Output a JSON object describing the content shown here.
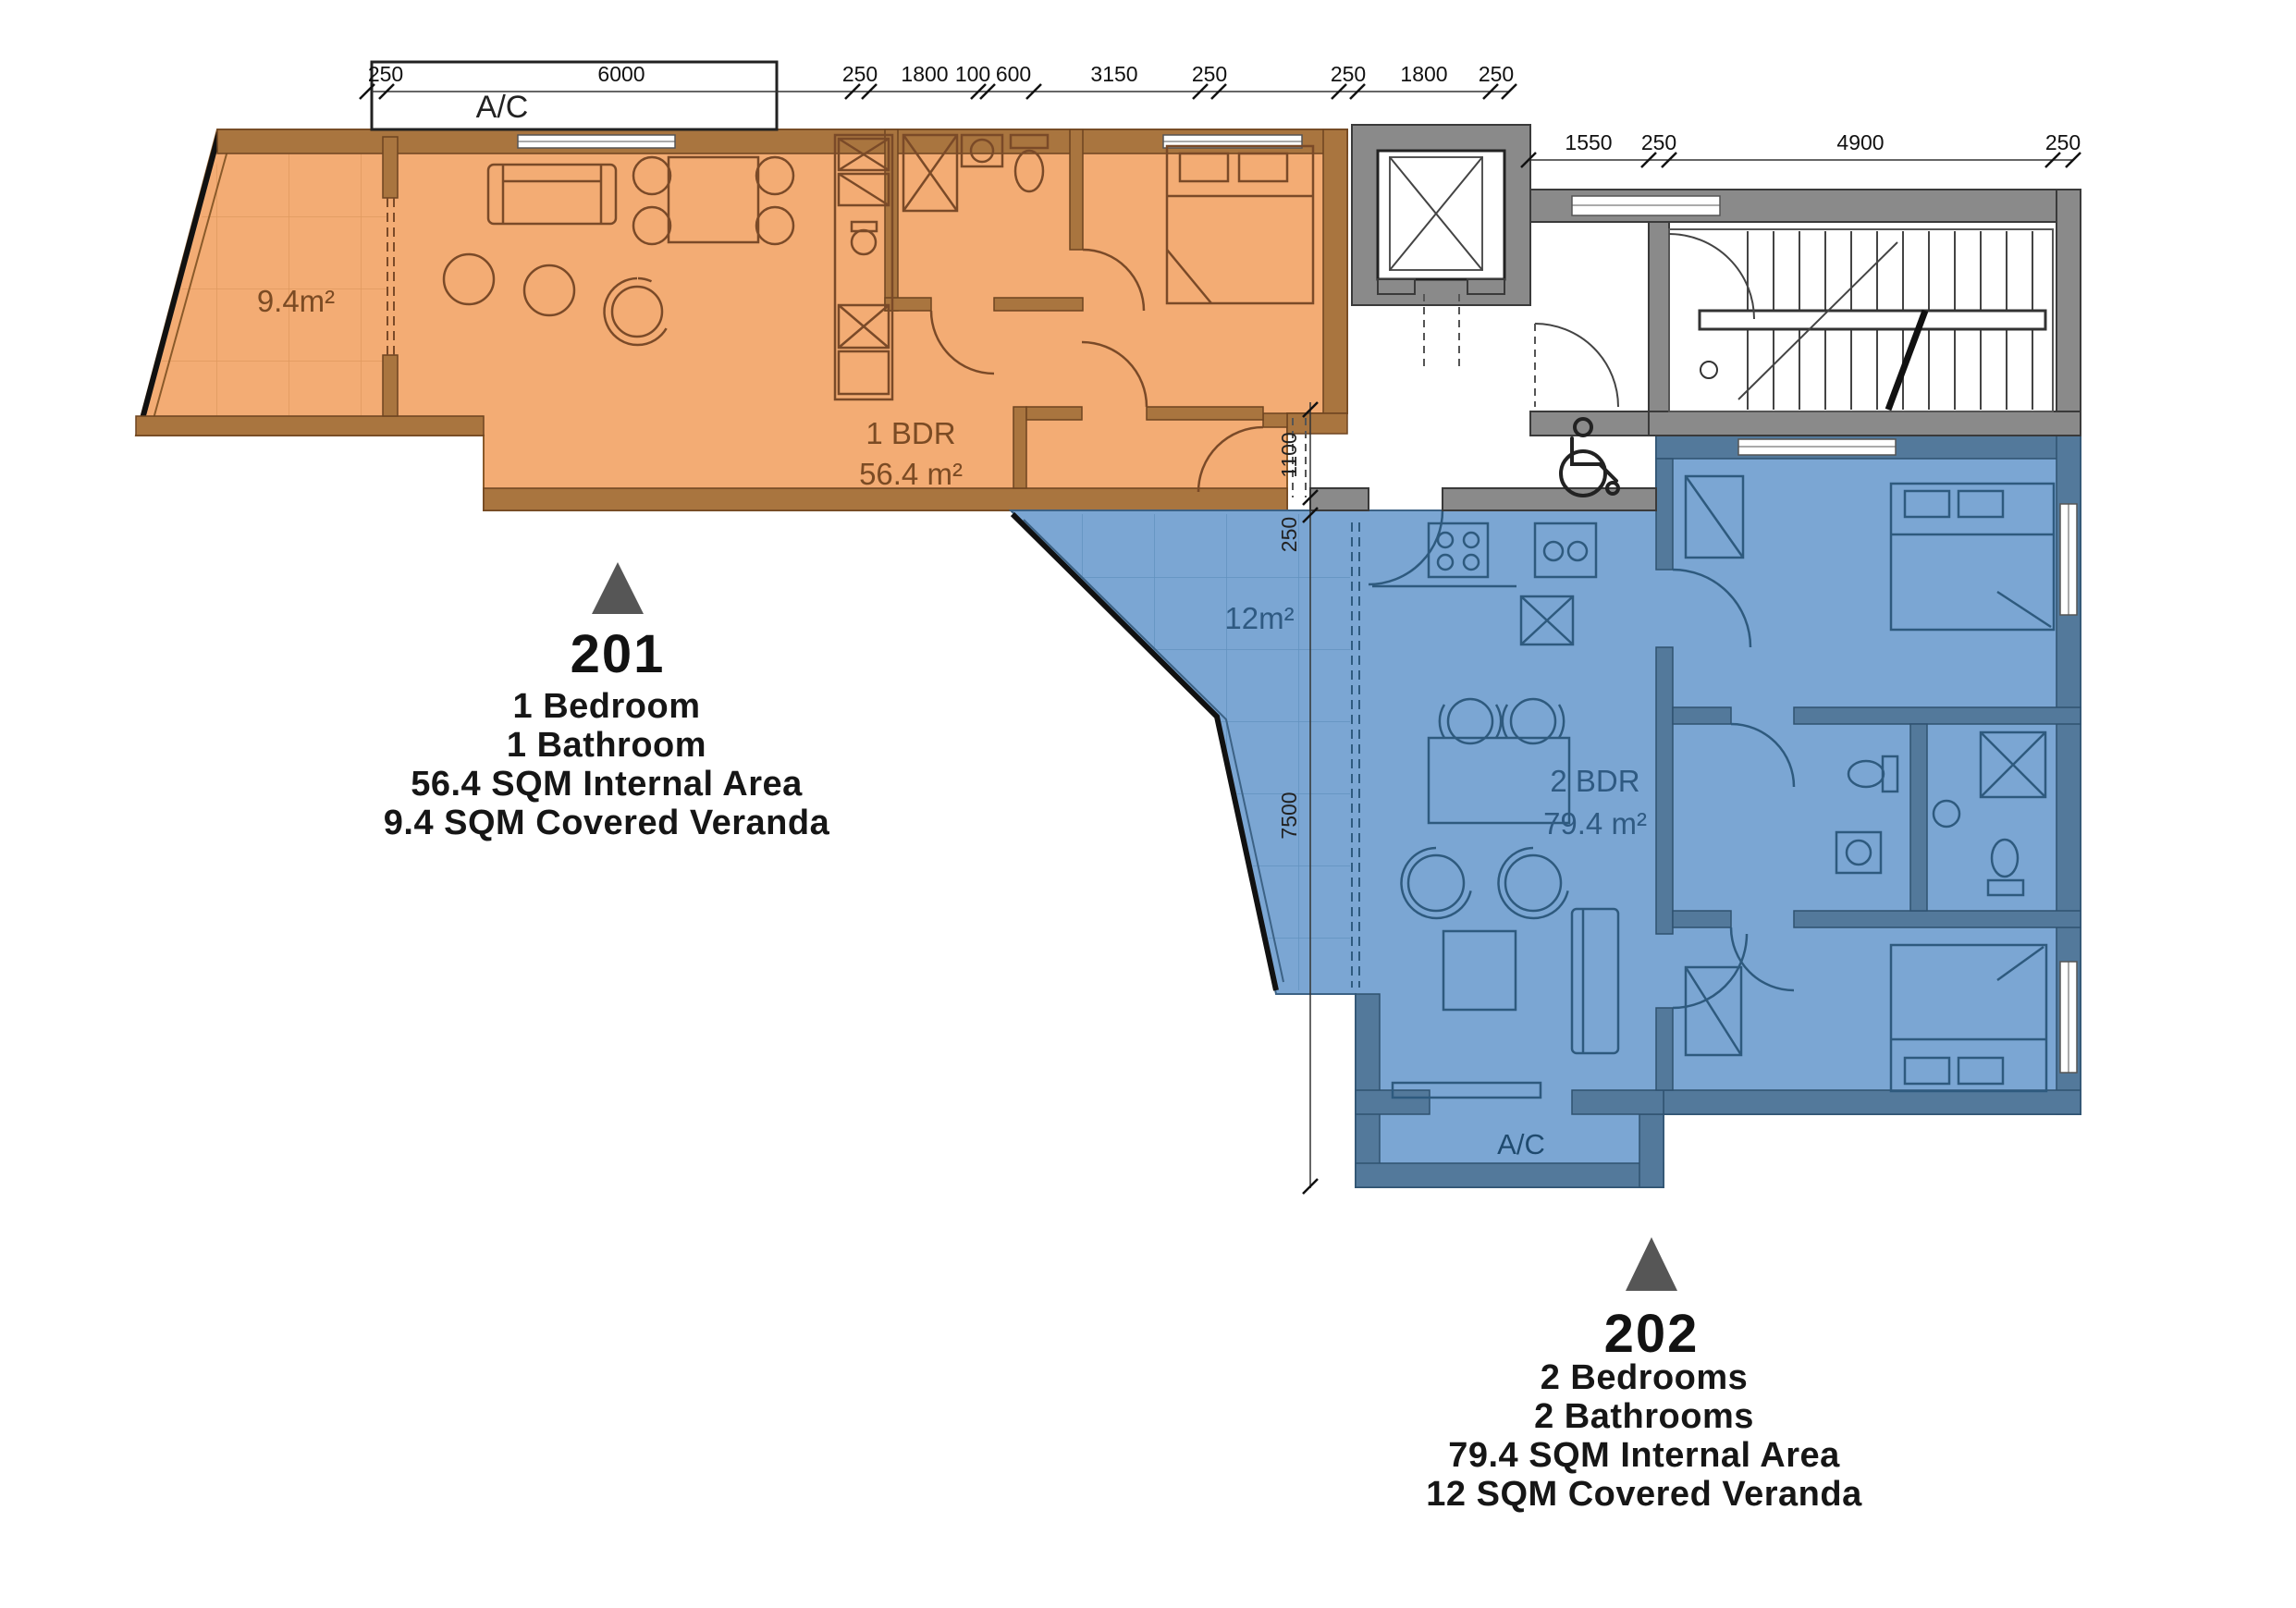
{
  "dims": {
    "top": [
      "250",
      "6000",
      "250",
      "1800",
      "100",
      "600",
      "3150",
      "250",
      "250",
      "1800",
      "250"
    ],
    "right": [
      "1550",
      "250",
      "4900",
      "250"
    ],
    "vertical": [
      "1100",
      "250",
      "7500"
    ]
  },
  "units": [
    {
      "number": "201",
      "specs": [
        "1 Bedroom",
        "1 Bathroom",
        "56.4 SQM Internal Area",
        "9.4 SQM Covered Veranda"
      ],
      "plan_label": "1 BDR",
      "plan_area": "56.4 m²",
      "veranda_label": "9.4m²",
      "ac_label": "A/C",
      "fill": "#f3ac74"
    },
    {
      "number": "202",
      "specs": [
        "2 Bedrooms",
        "2 Bathrooms",
        "79.4 SQM Internal Area",
        "12 SQM Covered Veranda"
      ],
      "plan_label": "2 BDR",
      "plan_area": "79.4 m²",
      "veranda_label": "12m²",
      "ac_label": "A/C",
      "fill": "#7ba6d3"
    }
  ],
  "colors": {
    "unit_201_fill": "#f3ac74",
    "unit_202_fill": "#7ba6d3",
    "core_wall_gray": "#8a8a8a",
    "marker_gray": "#565656"
  }
}
